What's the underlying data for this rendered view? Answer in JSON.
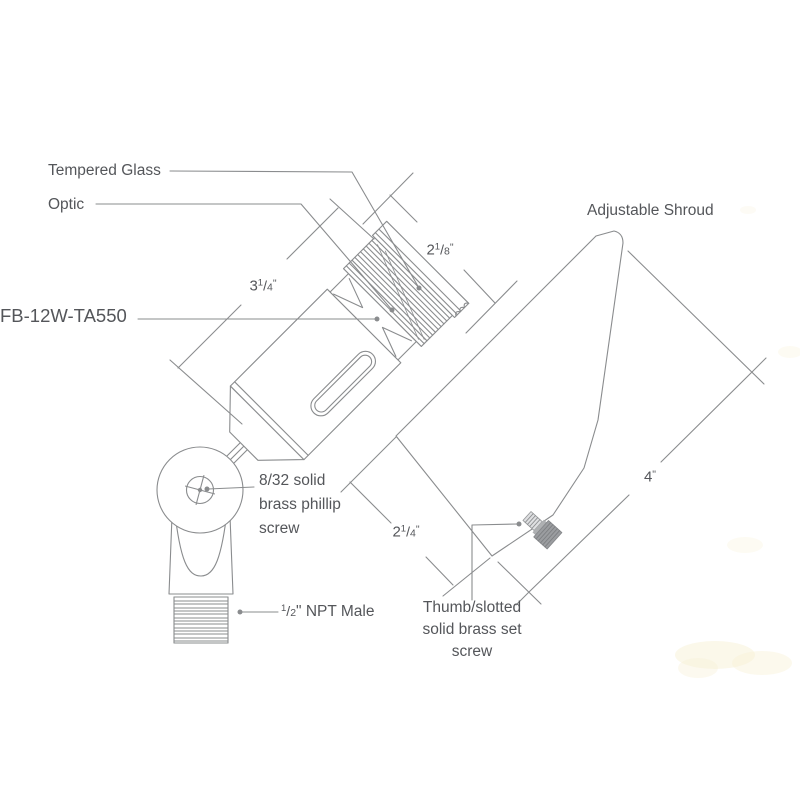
{
  "meta": {
    "line_color": "#8a8c8e",
    "text_color": "#54565a",
    "background": "#ffffff",
    "screw_fill": "#9b9da0"
  },
  "labels": {
    "tempered_glass": "Tempered Glass",
    "optic": "Optic",
    "adjustable_shroud": "Adjustable Shroud",
    "model": "FB-12W-TA550",
    "phillips_screw": {
      "lines": [
        "8/32 solid",
        "brass phillip",
        "screw"
      ]
    },
    "npt": {
      "num": "1",
      "slash": "/",
      "den": "2",
      "rest": "\" NPT Male"
    },
    "set_screw": {
      "lines": [
        "Thumb/slotted",
        "solid brass set",
        "screw"
      ]
    }
  },
  "dimensions": {
    "body_length": {
      "whole": "3",
      "num": "1",
      "slash": "/",
      "den": "4",
      "unit": "\""
    },
    "glass_diameter": {
      "whole": "2",
      "num": "1",
      "slash": "/",
      "den": "8",
      "unit": "\""
    },
    "mouth_opening": {
      "whole": "2",
      "num": "1",
      "slash": "/",
      "den": "4",
      "unit": "\""
    },
    "shroud_length": {
      "whole": "4",
      "num": "",
      "slash": "",
      "den": "",
      "unit": "\""
    }
  }
}
